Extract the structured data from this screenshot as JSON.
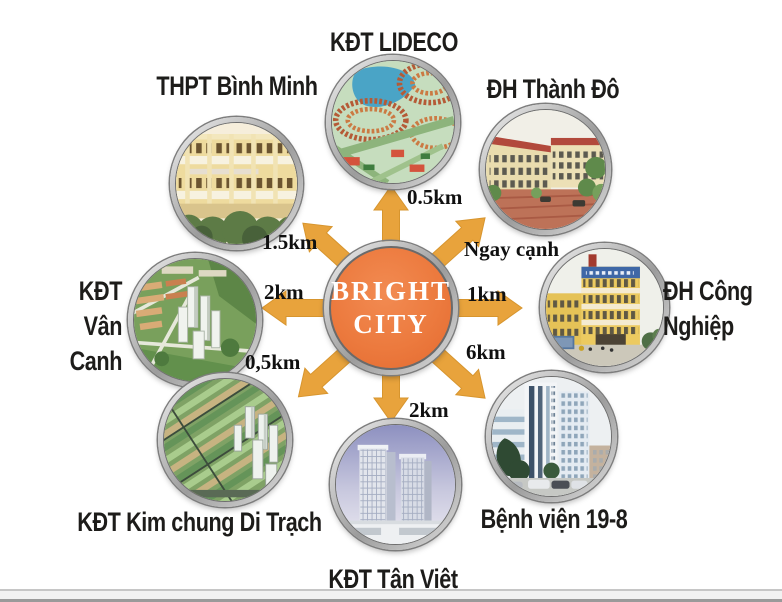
{
  "center": {
    "name": "BRIGHT CITY",
    "line1": "BRIGHT",
    "line2": "CITY"
  },
  "locations": [
    {
      "id": "kdt-lideco",
      "label": "KĐT LIDECO",
      "distance": "0.5km",
      "position": "top"
    },
    {
      "id": "thpt-binh-minh",
      "label": "THPT Bình Minh",
      "distance": "1.5km",
      "position": "top-left"
    },
    {
      "id": "dh-thanh-do",
      "label": "ĐH Thành Đô",
      "distance": "Ngay cạnh",
      "position": "top-right"
    },
    {
      "id": "kdt-van-canh",
      "label": "KĐT Vân Canh",
      "distance": "2km",
      "position": "left",
      "lines": [
        "KĐT",
        "Vân Canh"
      ]
    },
    {
      "id": "dh-cong-nghiep",
      "label": "ĐH Công Nghiệp",
      "distance": "1km",
      "position": "right",
      "lines": [
        "ĐH Công",
        "Nghiệp"
      ]
    },
    {
      "id": "kdt-kim-chung-di-trach",
      "label": "KĐT Kim chung Di Trạch",
      "distance": "0,5km",
      "position": "bottom-left"
    },
    {
      "id": "kdt-tan-viet",
      "label": "KĐT Tân Việt",
      "distance": "2km",
      "position": "bottom"
    },
    {
      "id": "benh-vien-19-8",
      "label": "Bệnh viện 19-8",
      "distance": "6km",
      "position": "bottom-right"
    }
  ],
  "colors": {
    "arrow": "#E8A33C",
    "center_fill": "#EC7A3E",
    "label_text": "#1D1C1A"
  }
}
